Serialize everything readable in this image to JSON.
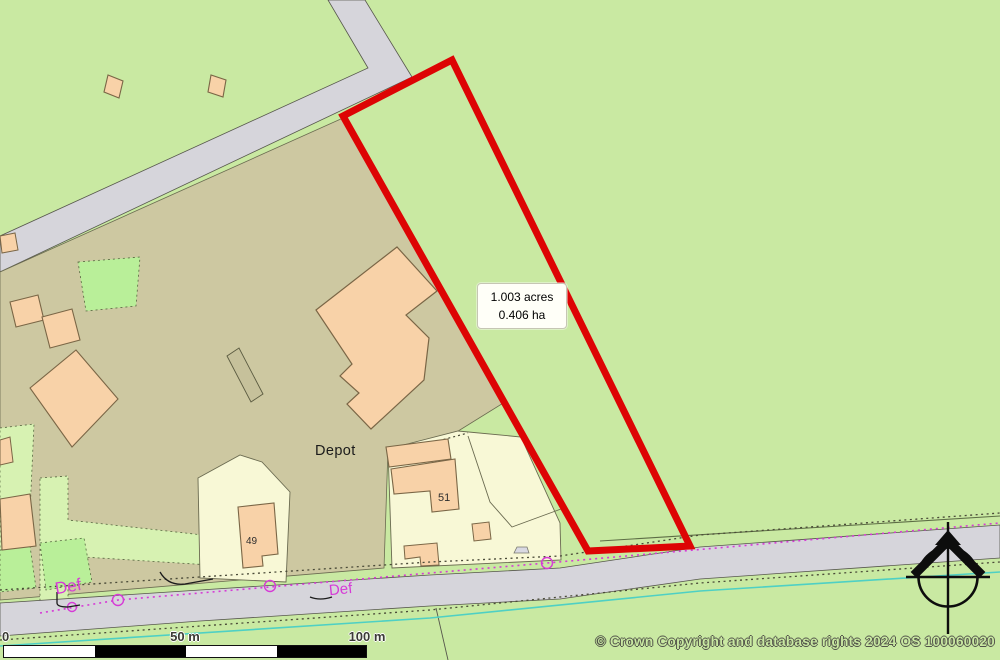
{
  "map": {
    "type": "os-property-plan",
    "plot": {
      "area_acres": "1.003 acres",
      "area_ha": "0.406 ha"
    },
    "labels": {
      "depot": "Depot",
      "house_49": "49",
      "house_51": "51",
      "def_west": "Def",
      "def_east": "Def"
    },
    "scale_bar": {
      "zero": "0",
      "fifty": "50 m",
      "hundred": "100 m"
    },
    "attribution": "© Crown Copyright and database rights 2024 OS 100060020",
    "icons": {
      "north_arrow": "compass-north-arrow"
    },
    "colors": {
      "field_green": "#c9e9a2",
      "bright_green": "#b9ef99",
      "pale_green": "#d7f2b2",
      "depot_olive": "#cdc8a1",
      "parcel_cream": "#f8f8d6",
      "building_peach": "#f8d2a8",
      "road_gray": "#d6d5db",
      "plot_outline_red": "#dd0404",
      "def_magenta": "#d63ad6",
      "drain_cyan": "#4ed0c4"
    }
  }
}
